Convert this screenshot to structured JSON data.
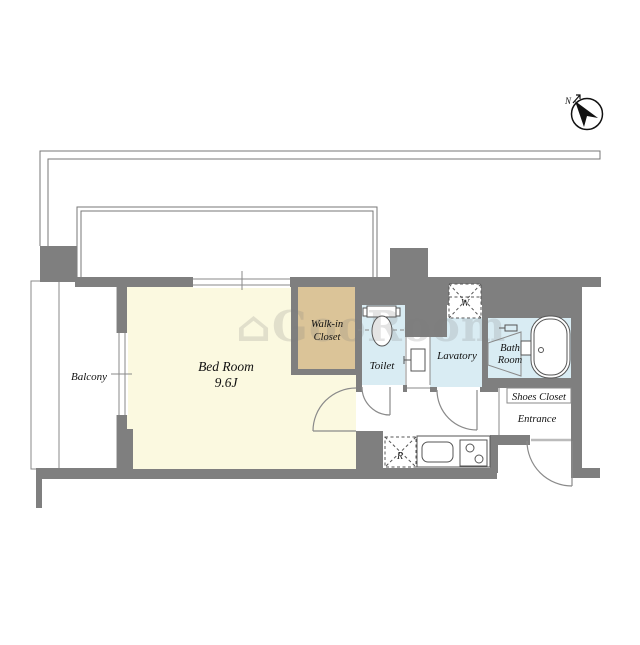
{
  "compass": {
    "north_label": "N"
  },
  "watermark": {
    "text": "⌂GooRoom"
  },
  "rooms": {
    "balcony": {
      "label": "Balcony"
    },
    "bed_room": {
      "label": "Bed Room",
      "size": "9.6J"
    },
    "walk_in_closet": {
      "line1": "Walk-in",
      "line2": "Closet"
    },
    "toilet": {
      "label": "Toilet"
    },
    "lavatory": {
      "label": "Lavatory"
    },
    "bath_room": {
      "line1": "Bath",
      "line2": "Room"
    },
    "shoes_closet": {
      "label": "Shoes Closet"
    },
    "entrance": {
      "label": "Entrance"
    }
  },
  "appliances": {
    "washing_machine": "W",
    "refrigerator": "R"
  },
  "colors": {
    "wall": "#7f7f7f",
    "bedroom_floor": "#fbf9e0",
    "closet_floor": "#dbc498",
    "wet_area_floor": "#d9ecf3",
    "outline": "#777777",
    "white": "#ffffff"
  }
}
